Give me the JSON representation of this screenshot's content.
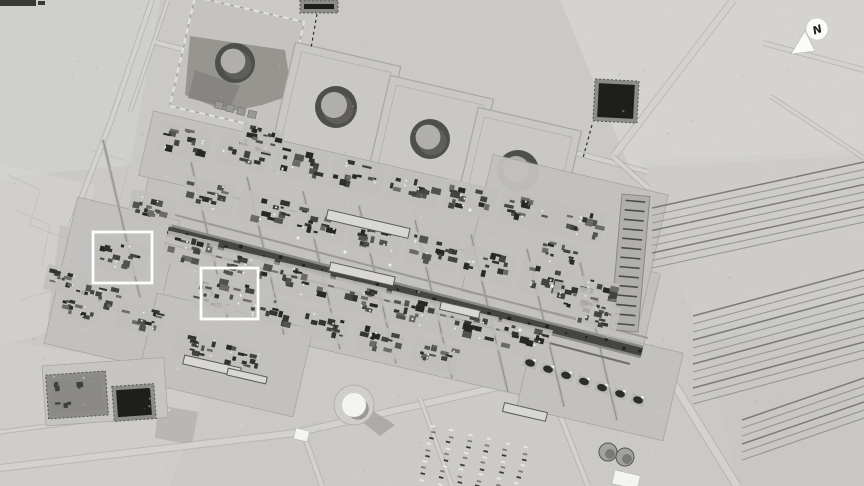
{
  "image": {
    "kind": "grayscale satellite photograph of a large oil processing facility and tank farm in desert terrain",
    "compass": {
      "label": "N",
      "cx": 817,
      "cy": 29,
      "r": 11,
      "arrow": [
        [
          791,
          54
        ],
        [
          805,
          31
        ],
        [
          815,
          51
        ]
      ]
    },
    "highlight_boxes": [
      {
        "x": 93,
        "y": 232,
        "w": 59,
        "h": 51
      },
      {
        "x": 201,
        "y": 268,
        "w": 57,
        "h": 51
      }
    ]
  },
  "palette": {
    "desert": "#cac9c6",
    "desertLight": "#d6d5d2",
    "desertDark": "#b9b8b5",
    "pad": "#c2c1be",
    "road": "#d3d2cf",
    "roadEdge": "#a7a6a3",
    "spine": "#454543",
    "spineEdge": "#8b8a86",
    "dark": "#393937",
    "white": "#f2f2f0",
    "pond": "#1e1e1d",
    "pondFrame": "#8d8c89",
    "tankRing": "#4e4e4b",
    "tankTop": "#b0afac",
    "tankShadow": "#5f5e5c",
    "clusterShades": [
      "#32322f",
      "#434341",
      "#52524f",
      "#6b6a67",
      "#272725"
    ]
  },
  "terrain_patches": [
    {
      "pts": "0,0 160,0 130,165 0,178",
      "f": "#d2d1ce",
      "o": 0.7
    },
    {
      "pts": "560,0 864,0 864,155 630,168",
      "f": "#d7d6d3",
      "o": 0.75
    },
    {
      "pts": "640,160 864,150 864,330 700,340",
      "f": "#cfcecb",
      "o": 0.6
    },
    {
      "pts": "0,165 95,185 60,330 0,345",
      "f": "#d4d3d0",
      "o": 0.6
    },
    {
      "pts": "0,340 210,375 170,486 0,486",
      "f": "#d1d0cd",
      "o": 0.65
    },
    {
      "pts": "320,395 565,375 600,486 330,486",
      "f": "#cdccc9",
      "o": 0.6
    },
    {
      "pts": "700,330 864,300 864,486 740,486",
      "f": "#c6c5c2",
      "o": 0.5
    },
    {
      "pts": "60,225 100,235 88,330 48,318",
      "f": "#b9b8b5",
      "o": 0.5
    },
    {
      "pts": "158,405 198,412 192,445 155,438",
      "f": "#b3b2af",
      "o": 0.8
    }
  ],
  "scratch_paths": [
    "8,175 40,190 30,225 70,240 55,290 20,300",
    "15,210 50,225 42,265 75,280",
    "90,150 130,162 120,200"
  ],
  "roads": [
    {
      "pts": [
        [
          152,
          0
        ],
        [
          112,
          118
        ],
        [
          70,
          228
        ]
      ],
      "w": 4
    },
    {
      "pts": [
        [
          168,
          0
        ],
        [
          130,
          112
        ]
      ],
      "w": 2.5
    },
    {
      "pts": [
        [
          733,
          0
        ],
        [
          613,
          157
        ]
      ],
      "w": 6
    },
    {
      "pts": [
        [
          763,
          43
        ],
        [
          864,
          70
        ]
      ],
      "w": 4
    },
    {
      "pts": [
        [
          770,
          96
        ],
        [
          864,
          158
        ]
      ],
      "w": 3
    },
    {
      "pts": [
        [
          155,
          42
        ],
        [
          648,
          172
        ]
      ],
      "w": 4
    },
    {
      "pts": [
        [
          0,
          468
        ],
        [
          295,
          433
        ],
        [
          560,
          373
        ],
        [
          655,
          348
        ]
      ],
      "w": 6
    },
    {
      "pts": [
        [
          303,
          432
        ],
        [
          322,
          486
        ]
      ],
      "w": 4
    },
    {
      "pts": [
        [
          545,
          377
        ],
        [
          588,
          486
        ]
      ],
      "w": 4
    },
    {
      "pts": [
        [
          653,
          350
        ],
        [
          737,
          486
        ]
      ],
      "w": 7
    },
    {
      "pts": [
        [
          420,
          398
        ],
        [
          452,
          486
        ]
      ],
      "w": 3
    },
    {
      "pts": [
        [
          265,
          332
        ],
        [
          287,
          396
        ]
      ],
      "w": 3
    },
    {
      "pts": [
        [
          613,
          157
        ],
        [
          648,
          188
        ]
      ],
      "w": 4
    },
    {
      "pts": [
        [
          0,
          432
        ],
        [
          170,
          410
        ]
      ],
      "w": 3
    }
  ],
  "survey_dashes": [
    {
      "x1": 317,
      "y1": 14,
      "x2": 311,
      "y2": 48
    },
    {
      "x1": 592,
      "y1": 125,
      "x2": 583,
      "y2": 158
    }
  ],
  "tank_farm": {
    "containments": [
      {
        "cx": 336,
        "cy": 107,
        "side": 108
      },
      {
        "cx": 430,
        "cy": 139,
        "side": 106
      },
      {
        "cx": 518,
        "cy": 171,
        "side": 106
      }
    ],
    "containment1": {
      "cx": 237,
      "cy": 64,
      "side": 112,
      "blob": "190,36 285,50 292,95 262,105 228,112 185,95",
      "blob2": "195,70 240,86 230,108 188,98"
    },
    "gray_sheds": [
      [
        216,
        101
      ],
      [
        227,
        104
      ],
      [
        238,
        107
      ],
      [
        249,
        110
      ]
    ],
    "tanks": [
      {
        "cx": 235,
        "cy": 63,
        "r": 20
      },
      {
        "cx": 336,
        "cy": 107,
        "r": 21
      },
      {
        "cx": 430,
        "cy": 139,
        "r": 20
      },
      {
        "cx": 518,
        "cy": 171,
        "r": 21
      }
    ]
  },
  "ponds": [
    {
      "x": 300,
      "y": 0,
      "w": 38,
      "h": 13,
      "angle": 0,
      "type": "dark"
    },
    {
      "x": 594,
      "y": 80,
      "w": 44,
      "h": 42,
      "angle": 3,
      "type": "dark"
    },
    {
      "x": 47,
      "y": 373,
      "w": 60,
      "h": 44,
      "angle": -4,
      "type": "mottled"
    },
    {
      "x": 113,
      "y": 385,
      "w": 42,
      "h": 35,
      "angle": -4,
      "type": "dark"
    }
  ],
  "pond_pad": {
    "x": 42,
    "y": 366,
    "w": 122,
    "h": 60,
    "angle": -4
  },
  "pads": [
    {
      "cx": 390,
      "cy": 288,
      "w": 520,
      "h": 150
    },
    {
      "cx": 375,
      "cy": 196,
      "w": 470,
      "h": 66
    },
    {
      "cx": 112,
      "cy": 282,
      "w": 105,
      "h": 150
    },
    {
      "cx": 565,
      "cy": 243,
      "w": 180,
      "h": 140
    },
    {
      "cx": 225,
      "cy": 355,
      "w": 160,
      "h": 90
    },
    {
      "cx": 600,
      "cy": 380,
      "w": 150,
      "h": 90
    }
  ],
  "spine": {
    "x1": 168,
    "y1": 230,
    "x2": 642,
    "y2": 352
  },
  "street_xs": [
    120,
    208,
    264,
    320,
    376,
    432,
    488,
    544,
    597
  ],
  "clusters": [
    [
      185,
      142,
      1
    ],
    [
      243,
      153,
      1
    ],
    [
      300,
      164,
      1
    ],
    [
      357,
      176,
      1
    ],
    [
      414,
      188,
      1
    ],
    [
      470,
      200,
      1
    ],
    [
      526,
      212,
      1
    ],
    [
      578,
      224,
      1
    ],
    [
      152,
      208,
      0.9
    ],
    [
      208,
      196,
      1
    ],
    [
      264,
      210,
      1
    ],
    [
      320,
      224,
      1
    ],
    [
      376,
      238,
      1
    ],
    [
      432,
      252,
      1
    ],
    [
      488,
      266,
      1
    ],
    [
      544,
      281,
      1
    ],
    [
      594,
      293,
      0.9
    ],
    [
      190,
      252,
      1
    ],
    [
      246,
      269,
      1
    ],
    [
      302,
      283,
      1
    ],
    [
      358,
      298,
      1
    ],
    [
      414,
      312,
      1
    ],
    [
      470,
      327,
      1
    ],
    [
      524,
      340,
      1
    ],
    [
      215,
      297,
      0.9
    ],
    [
      270,
      311,
      0.9
    ],
    [
      325,
      326,
      0.9
    ],
    [
      380,
      341,
      0.9
    ],
    [
      435,
      356,
      0.9
    ],
    [
      122,
      257,
      1
    ],
    [
      100,
      296,
      0.9
    ],
    [
      140,
      319,
      0.9
    ],
    [
      80,
      308,
      0.8
    ],
    [
      66,
      281,
      0.8
    ],
    [
      228,
      293,
      1
    ],
    [
      198,
      347,
      0.9
    ],
    [
      242,
      359,
      0.8
    ],
    [
      575,
      300,
      0.9
    ],
    [
      598,
      316,
      0.8
    ],
    [
      560,
      255,
      0.8
    ],
    [
      262,
      139,
      0.8
    ]
  ],
  "long_buildings": [
    [
      368,
      224,
      84,
      10
    ],
    [
      362,
      274,
      66,
      9
    ],
    [
      525,
      412,
      44,
      9
    ],
    [
      212,
      366,
      58,
      9
    ],
    [
      247,
      376,
      40,
      7
    ],
    [
      460,
      310,
      40,
      8
    ]
  ],
  "pipe_fans": [
    {
      "x1": 652,
      "y1": 208,
      "x2": 864,
      "y2": 162,
      "n": 9,
      "gap": 7.5
    },
    {
      "x1": 693,
      "y1": 316,
      "x2": 864,
      "y2": 270,
      "n": 12,
      "gap": 8
    },
    {
      "x1": 742,
      "y1": 420,
      "x2": 864,
      "y2": 378,
      "n": 6,
      "gap": 8
    }
  ],
  "pipe_column": {
    "cx": 630,
    "cy": 263,
    "w": 28,
    "h": 136,
    "tilt": 5
  },
  "unit_row": {
    "x1": 530,
    "y1": 363,
    "x2": 638,
    "y2": 400,
    "n": 7
  },
  "yard": {
    "x": 430,
    "y": 424,
    "cols": 6,
    "rows": 10
  },
  "small_tanks": [
    [
      608,
      452,
      9
    ],
    [
      625,
      457,
      9
    ]
  ],
  "white_buildings": [
    [
      296,
      428,
      14,
      11
    ],
    [
      615,
      470,
      26,
      14
    ]
  ],
  "dome": {
    "cx": 354,
    "cy": 405,
    "r": 12
  },
  "dark_wedge": "368,408 395,425 380,436 360,420",
  "top_bars": [
    [
      0,
      0,
      36,
      6
    ],
    [
      38,
      1,
      7,
      4
    ]
  ],
  "white_dots": [
    [
      298,
      238
    ],
    [
      345,
      252
    ],
    [
      390,
      265
    ],
    [
      520,
      330
    ],
    [
      470,
      210
    ],
    [
      552,
      286
    ]
  ]
}
